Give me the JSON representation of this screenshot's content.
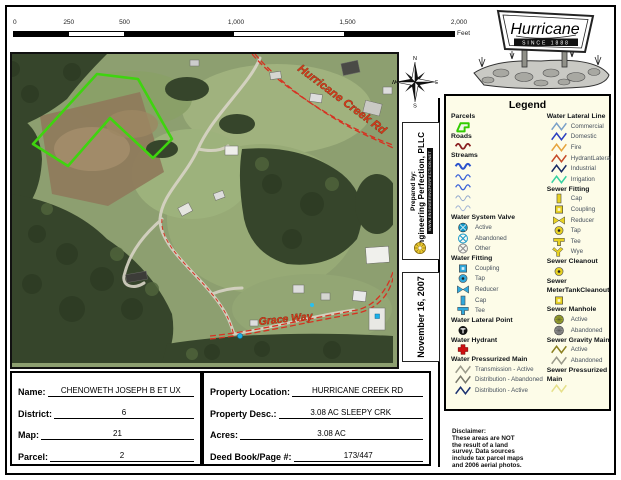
{
  "scalebar": {
    "ticks": [
      {
        "label": "0",
        "pos": 0
      },
      {
        "label": "250",
        "pos": 12.5
      },
      {
        "label": "500",
        "pos": 25
      },
      {
        "label": "1,000",
        "pos": 50
      },
      {
        "label": "1,500",
        "pos": 75
      },
      {
        "label": "2,000",
        "pos": 100
      }
    ],
    "unit": "Feet"
  },
  "compass": {
    "n": "N",
    "e": "E",
    "s": "S",
    "w": "W"
  },
  "logo": {
    "name": "Hurricane",
    "tagline": "SINCE 1888"
  },
  "prepared": {
    "prefix": "Prepared by:",
    "company": "Engineering Perfection, PLLC",
    "website": "WWW.ENGINEERINGPERFECTION.NET"
  },
  "date_label": "November 16, 2007",
  "map": {
    "roads": [
      {
        "label": "Hurricane Creek Rd"
      },
      {
        "label": "Grace Way"
      }
    ],
    "parcel_color": "#3fd40f",
    "road_color": "#d63222",
    "road_label_color": "#cf3b1a"
  },
  "legend": {
    "title": "Legend",
    "columns": [
      [
        {
          "h": "Parcels",
          "items": [
            {
              "i": [
                "poly",
                "#33cc00"
              ]
            }
          ]
        },
        {
          "h": "Roads",
          "items": [
            {
              "i": [
                "wave",
                "#8a2020",
                2.2
              ]
            }
          ]
        },
        {
          "h": "Streams",
          "items": [
            {
              "i": [
                "wave",
                "#2a52cc",
                2.6
              ]
            },
            {
              "i": [
                "wave",
                "#3a62d8",
                1.6
              ]
            },
            {
              "i": [
                "wave",
                "#3a62d8",
                1.6
              ]
            },
            {
              "i": [
                "wave",
                "#8fa6cc",
                1.1
              ]
            },
            {
              "i": [
                "wave",
                "#9fb2d4",
                1.1
              ]
            }
          ]
        },
        {
          "h": "Water System Valve",
          "items": [
            {
              "i": [
                "circ",
                "#1598c8"
              ],
              "l": "Active"
            },
            {
              "i": [
                "circx",
                "#1598c8"
              ],
              "l": "Abandoned"
            },
            {
              "i": [
                "circx",
                "#8a8a8a"
              ],
              "l": "Other"
            }
          ]
        },
        {
          "h": "Water Fitting",
          "items": [
            {
              "i": [
                "sq",
                "#2fa8dc"
              ],
              "l": "Coupling"
            },
            {
              "i": [
                "dot",
                "#2fa8dc"
              ],
              "l": "Tap"
            },
            {
              "i": [
                "bow",
                "#2fa8dc"
              ],
              "l": "Reducer"
            },
            {
              "i": [
                "cap",
                "#2fa8dc"
              ],
              "l": "Cap"
            },
            {
              "i": [
                "tee",
                "#2fa8dc"
              ],
              "l": "Tee"
            }
          ]
        },
        {
          "h": "Water Lateral Point",
          "items": [
            {
              "i": [
                "lat",
                "#111111"
              ]
            }
          ]
        },
        {
          "h": "Water Hydrant",
          "items": [
            {
              "i": [
                "cross",
                "#cc1111"
              ]
            }
          ]
        },
        {
          "h": "Water Pressurized Main",
          "items": [
            {
              "i": [
                "zig",
                "#9a9a8a"
              ],
              "l": "Transmission - Active"
            },
            {
              "i": [
                "zig",
                "#77776a"
              ],
              "l": "Distribution - Abandoned"
            },
            {
              "i": [
                "zig",
                "#1a3070"
              ],
              "l": "Distribution - Active"
            }
          ]
        }
      ],
      [
        {
          "h": "Water Lateral Line",
          "items": [
            {
              "i": [
                "zig",
                "#7aa0c8"
              ],
              "l": "Commercial"
            },
            {
              "i": [
                "zig",
                "#2b3fc0"
              ],
              "l": "Domestic"
            },
            {
              "i": [
                "zig",
                "#e6a33c"
              ],
              "l": "Fire"
            },
            {
              "i": [
                "zig",
                "#c64a28"
              ],
              "l": "HydrantLateral"
            },
            {
              "i": [
                "zig",
                "#172a63"
              ],
              "l": "Industrial"
            },
            {
              "i": [
                "zig",
                "#35d1a0"
              ],
              "l": "Irrigation"
            }
          ]
        },
        {
          "h": "Sewer Fitting",
          "items": [
            {
              "i": [
                "cap",
                "#e8d222"
              ],
              "l": "Cap"
            },
            {
              "i": [
                "sq",
                "#e8d222"
              ],
              "l": "Coupling"
            },
            {
              "i": [
                "bow",
                "#e8d222"
              ],
              "l": "Reducer"
            },
            {
              "i": [
                "dot",
                "#e8d222"
              ],
              "l": "Tap"
            },
            {
              "i": [
                "tee",
                "#e8d222"
              ],
              "l": "Tee"
            },
            {
              "i": [
                "wye",
                "#e8d222"
              ],
              "l": "Wye"
            }
          ]
        },
        {
          "h": "Sewer Cleanout",
          "items": [
            {
              "i": [
                "dot",
                "#e8d222"
              ]
            }
          ]
        },
        {
          "h": "Sewer MeterTankCleanout",
          "items": [
            {
              "i": [
                "sq",
                "#e8d222"
              ]
            }
          ]
        },
        {
          "h": "Sewer Manhole",
          "items": [
            {
              "i": [
                "man",
                "#97a02c"
              ],
              "l": "Active"
            },
            {
              "i": [
                "man",
                "#8a8a8a"
              ],
              "l": "Abandoned"
            }
          ]
        },
        {
          "h": "Sewer Gravity Main",
          "items": [
            {
              "i": [
                "zig",
                "#8a7f1e"
              ],
              "l": "Active"
            },
            {
              "i": [
                "zig",
                "#99998a"
              ],
              "l": "Abandoned"
            }
          ]
        },
        {
          "h": "Sewer Pressurized Main",
          "items": [
            {
              "i": [
                "zig",
                "#e6e08a"
              ]
            }
          ]
        }
      ]
    ]
  },
  "form": {
    "left": [
      {
        "label": "Name:",
        "value": "CHENOWETH JOSEPH B ET UX"
      },
      {
        "label": "District:",
        "value": "6"
      },
      {
        "label": "Map:",
        "value": "21"
      },
      {
        "label": "Parcel:",
        "value": "2"
      }
    ],
    "right": [
      {
        "label": "Property Location:",
        "value": "HURRICANE CREEK RD"
      },
      {
        "label": "Property Desc.:",
        "value": "3.08 AC SLEEPY CRK"
      },
      {
        "label": "Acres:",
        "value": "3.08 AC"
      },
      {
        "label": "Deed Book/Page #:",
        "value": "173/447"
      }
    ]
  },
  "disclaimer": {
    "lines": [
      "Disclaimer:",
      "These areas are NOT",
      "the result of a land",
      "survey. Data sources",
      "include tax parcel maps",
      "and 2006 aerial photos."
    ]
  }
}
